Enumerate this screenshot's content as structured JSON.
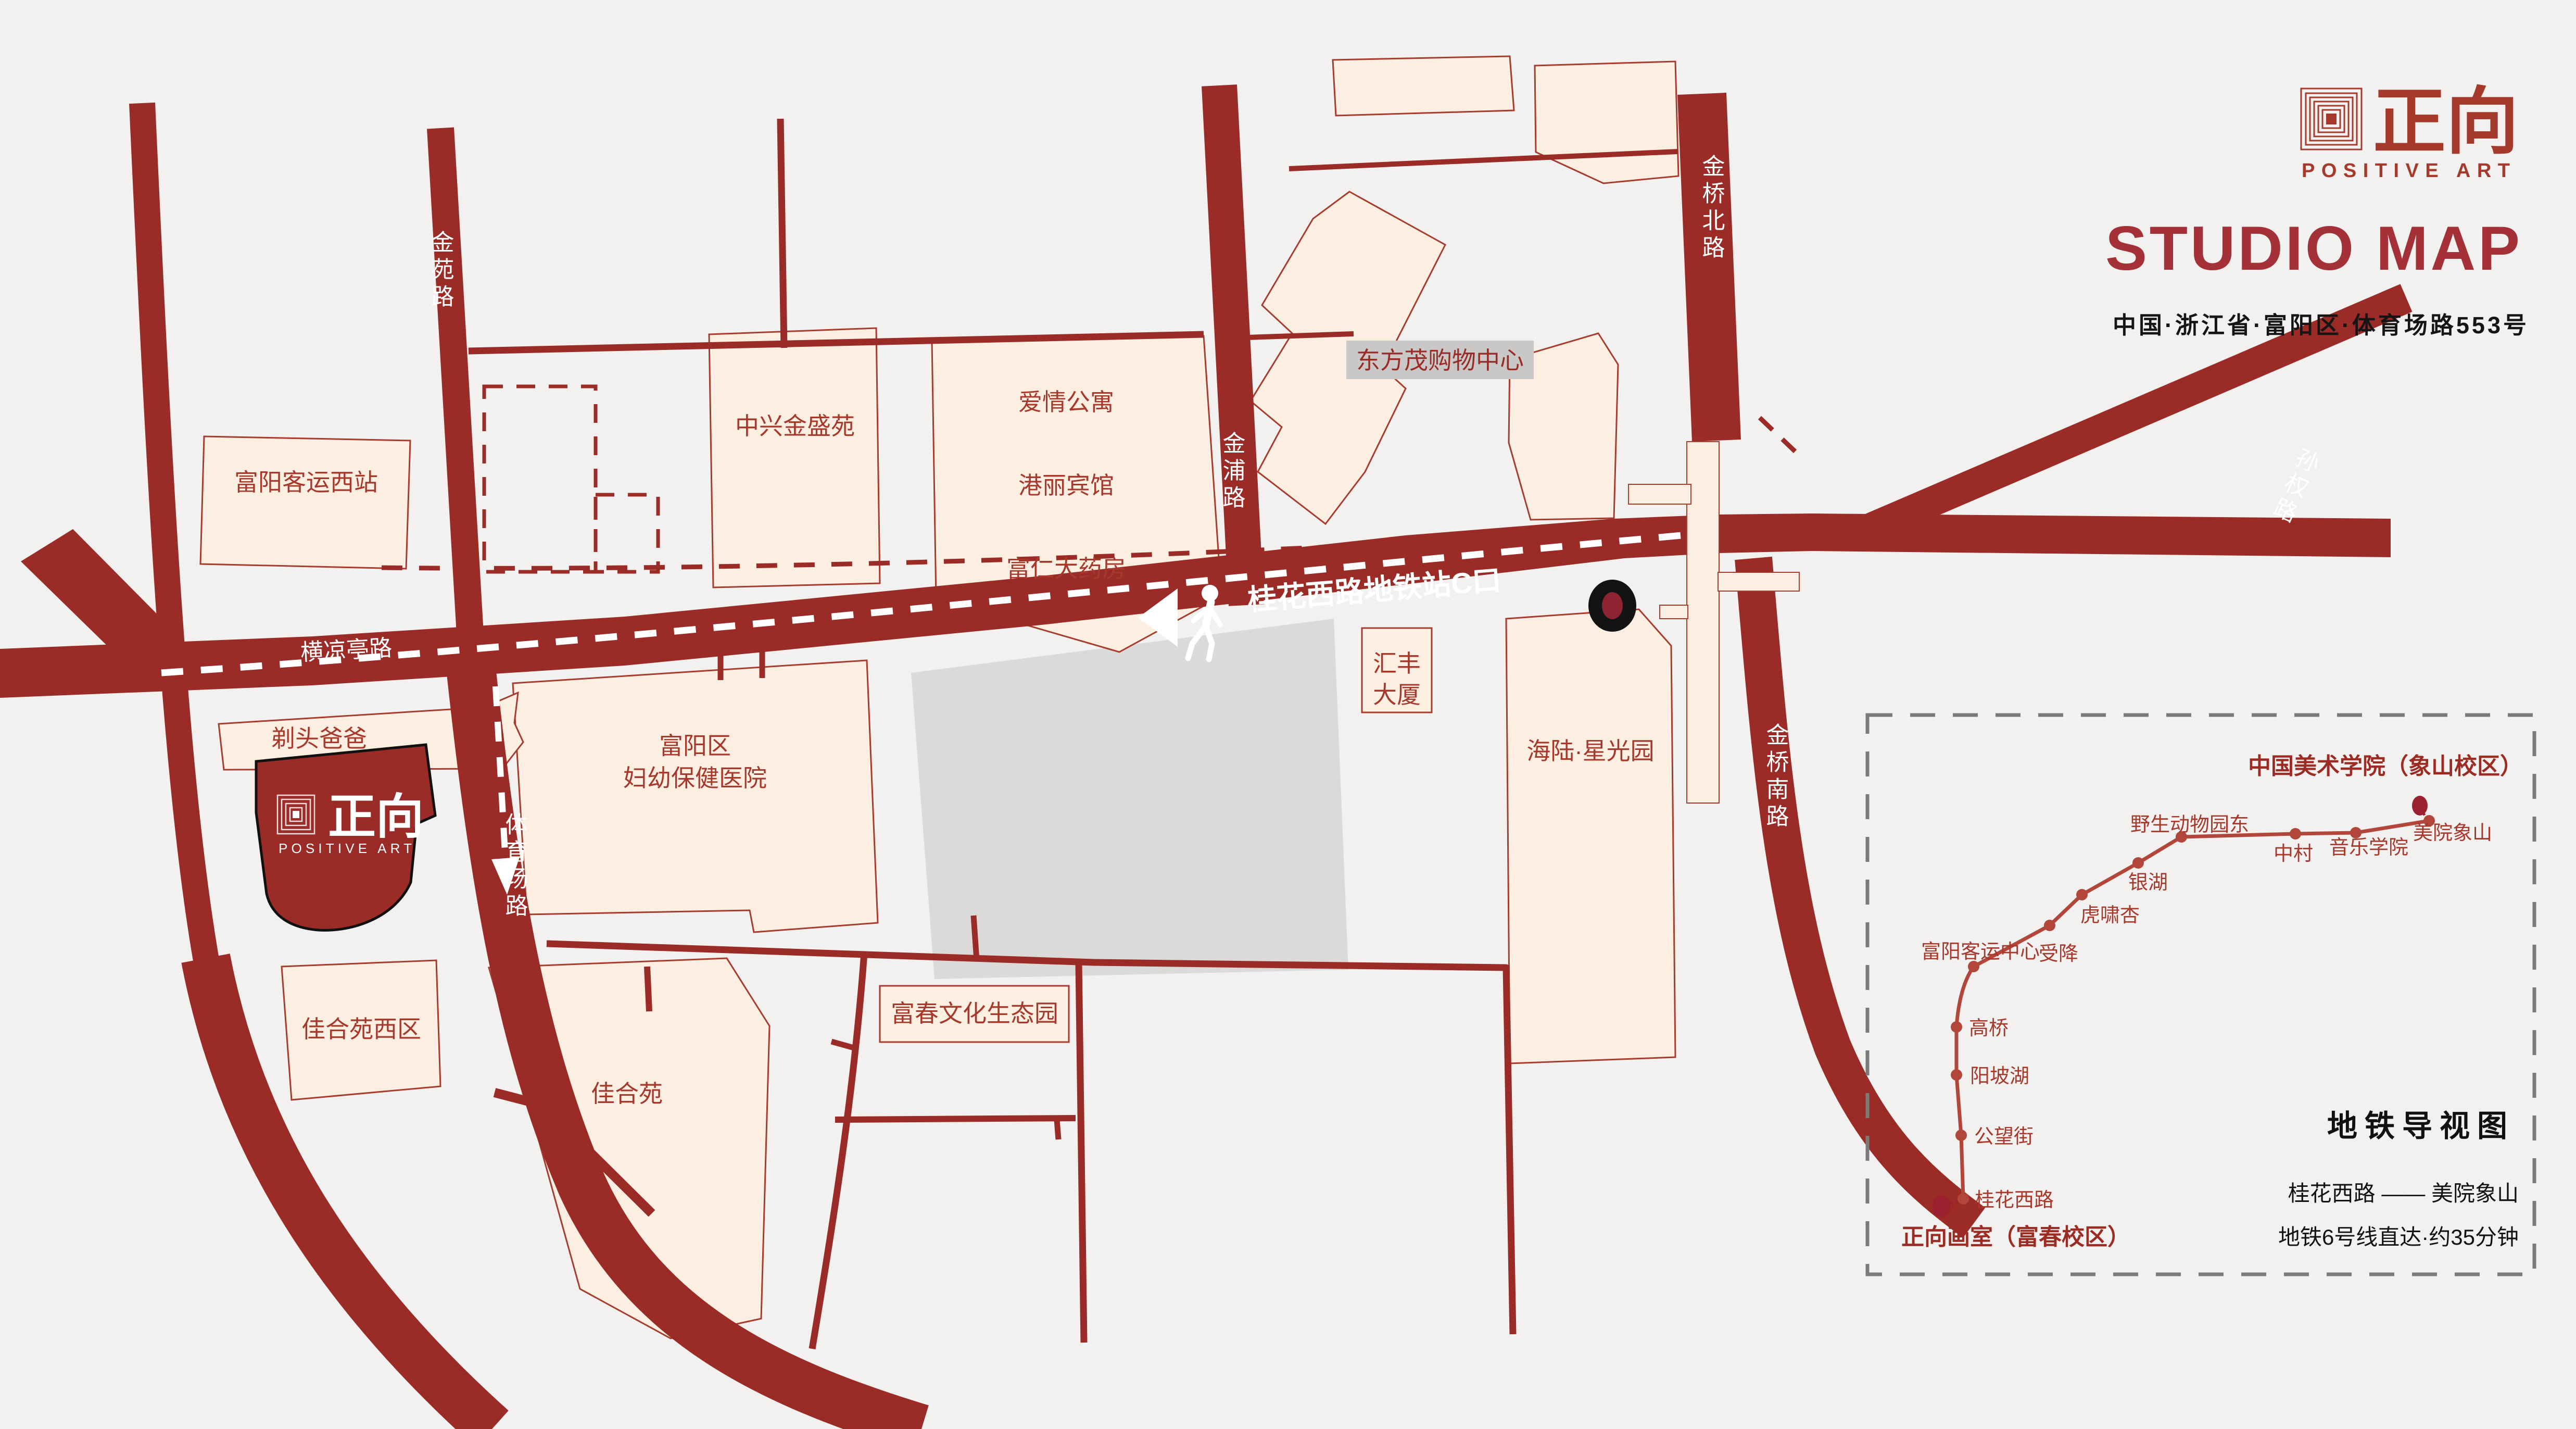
{
  "header": {
    "logo_cn": "正向",
    "logo_en": "POSITIVE ART",
    "title": "STUDIO MAP",
    "address": "中国·浙江省·富阳区·体育场路553号"
  },
  "roads": {
    "jinyuan": "金苑路",
    "jinpu": "金浦路",
    "jinqiao_north": "金桥北路",
    "sunquan": "孙权路",
    "hengliangting": "横凉亭路",
    "tiyuchang": "体育场路",
    "jinqiao_south": "金桥南路"
  },
  "walk_route": {
    "exit_label": "桂花西路地铁站C口"
  },
  "buildings": {
    "west_station": "富阳客运西站",
    "zhongxing": "中兴金盛苑",
    "aiqing": "爱情公寓",
    "gangli": "港丽宾馆",
    "furen": "富仁大药房",
    "dongfangmao": "东方茂购物中心",
    "huifeng_l1": "汇丰",
    "huifeng_l2": "大厦",
    "hailu": "海陆·星光园",
    "hospital_l1": "富阳区",
    "hospital_l2": "妇幼保健医院",
    "titou": "剃头爸爸",
    "jiaheyuan_west": "佳合苑西区",
    "jiaheyuan": "佳合苑",
    "fuchun_park": "富春文化生态园"
  },
  "studio": {
    "logo_cn": "正向",
    "logo_en": "POSITIVE ART"
  },
  "metro": {
    "title": "地铁导视图",
    "route_endpoints": "桂花西路 —— 美院象山",
    "duration": "地铁6号线直达·约35分钟",
    "terminal_start": "正向画室（富春校区）",
    "terminal_end": "中国美术学院（象山校区）",
    "stations": [
      {
        "name": "桂花西路"
      },
      {
        "name": "公望街"
      },
      {
        "name": "阳坡湖"
      },
      {
        "name": "高桥"
      },
      {
        "name": "富阳客运中心"
      },
      {
        "name": "受降"
      },
      {
        "name": "虎啸杏"
      },
      {
        "name": "银湖"
      },
      {
        "name": "野生动物园东"
      },
      {
        "name": "中村"
      },
      {
        "name": "音乐学院"
      },
      {
        "name": "美院象山"
      }
    ]
  },
  "colors": {
    "road": "#9b2b26",
    "building_fill": "#fcefe2",
    "building_stroke": "#a63b2e",
    "text_red": "#a6392c",
    "gray_block": "#dbdad8",
    "gray_road": "#d3d2cf",
    "metro_line": "#b2463a",
    "terminal_dot": "#9c2030",
    "title_red": "#a43038",
    "bg": "#f2f1ef",
    "label_gray": "#c9c8c6"
  }
}
